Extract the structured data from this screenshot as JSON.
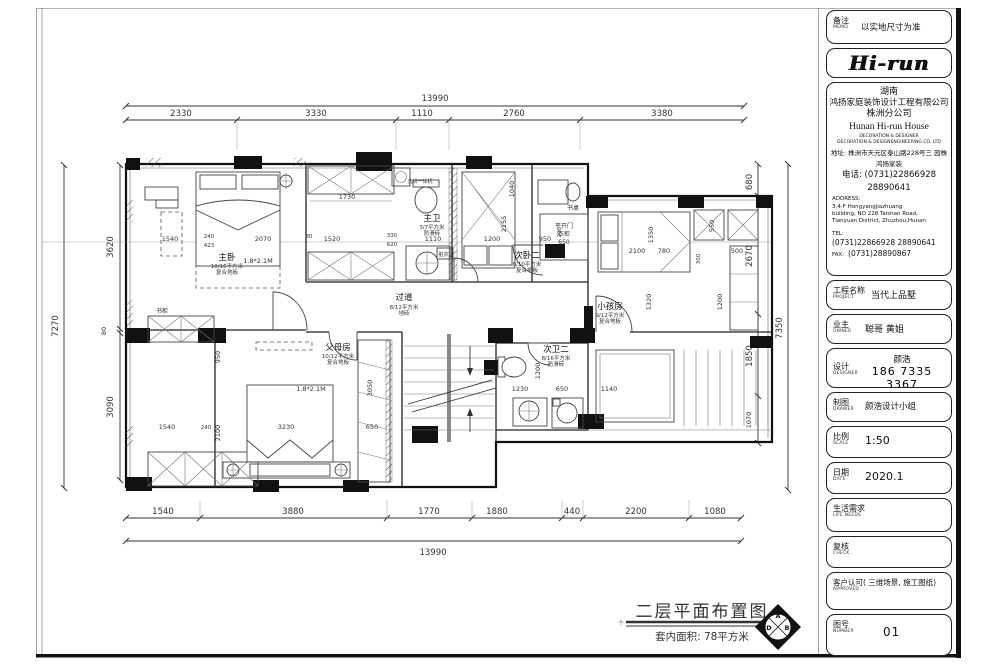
{
  "titleblock": {
    "memo": {
      "label": "备注",
      "en": "MEMO",
      "value": "以实地尺寸为准"
    },
    "logo": "Hi-run",
    "company": {
      "region": "湖南",
      "name": "鸿扬家庭装饰设计工程有限公司",
      "branch": "株洲分公司",
      "name_en": "Hunan  Hi-run  House",
      "tag1": "DECORATION & DESIGNER",
      "tag2": "DECORATION & DESIGNENGINEERING CO. LTD",
      "addr": "地址: 株洲市天元区泰山路228号三 园株",
      "addr2": "鸿扬家装",
      "phone": "电话: (0731)22866928",
      "phone2": "28890641",
      "address_label": "ADDRESS:",
      "address1": "3,4-F Hongyangjiazhuang",
      "address2": "building, NO 228 Taishan Road,",
      "address3": "Tianyuan District, Zhuzhou,Hunan",
      "tel_label": "TEL:",
      "tel": "(0731)22866928",
      "tel2": "28890641",
      "fax_label": "FAX:",
      "fax": "(0731)28890867"
    },
    "project": {
      "label": "工程名称",
      "en": "PROJECT",
      "value": "当代上品墅"
    },
    "owner": {
      "label": "业主",
      "en": "OWNER",
      "value": "聪哥  黄姐"
    },
    "designer": {
      "label": "设计",
      "en": "DESIGNER",
      "value": "颜浩",
      "value2": "186 7335 3367"
    },
    "drawer": {
      "label": "制图",
      "en": "DRAWER",
      "value": "颜浩设计小组"
    },
    "scale": {
      "label": "比例",
      "en": "SCALE",
      "value": "1:50"
    },
    "date": {
      "label": "日期",
      "en": "DATE",
      "value": "2020.1"
    },
    "life": {
      "label": "生活需求",
      "en": "LIFE  NEEDS",
      "value": ""
    },
    "check": {
      "label": "复核",
      "en": "CHECK",
      "value": ""
    },
    "approved": {
      "label": "客户认可( 三维场景, 施工图纸)",
      "en": "APPROVED",
      "value": ""
    },
    "number": {
      "label": "图号",
      "en": "NUMBER",
      "value": "01"
    }
  },
  "footer": {
    "title": "二层平面布置图",
    "area": "套内面积: 78平方米",
    "compass": {
      "top": "A",
      "right": "B",
      "bottom": "C",
      "left": "D"
    }
  },
  "plan": {
    "rooms": {
      "master": {
        "name": "主卧",
        "area": "10/16平方米",
        "floor": "复合地板",
        "bed": "1.8*2.1M"
      },
      "master_bath": {
        "name": "主卫",
        "area": "3/7平方米",
        "floor": "防滑砖"
      },
      "hallway": {
        "name": "过道",
        "area": "8/12平方米",
        "floor": "地砖"
      },
      "second": {
        "name": "次卧二",
        "area": "8/10平方米",
        "floor": "复合地板"
      },
      "kids": {
        "name": "小孩房",
        "area": "9/12平方米",
        "floor": "复合地板"
      },
      "parents": {
        "name": "父母房",
        "area": "10/12平方米",
        "floor": "复合地板",
        "bed": "1.8*2.1M"
      },
      "second_bath": {
        "name": "次卫二",
        "area": "8/16平方米",
        "floor": "防滑砖"
      },
      "desk": {
        "name": "书桌"
      },
      "wardrobe": {
        "line1": "平开门",
        "line2": "衣柜",
        "line3": "650"
      },
      "washer": {
        "name": "洗烘一体机"
      },
      "basket": {
        "name": "脏衣篮"
      },
      "bookcase": {
        "name": "书柜"
      }
    },
    "dims": {
      "top": {
        "overall": "13990",
        "segments": [
          "2330",
          "3330",
          "1110",
          "2760",
          "3380"
        ]
      },
      "bottom": {
        "overall": "13990",
        "segments": [
          "1540",
          "3880",
          "1770",
          "1880",
          "440",
          "2200",
          "1080"
        ]
      },
      "left": {
        "overall": "7270",
        "segments": [
          "3620",
          "80",
          "3090"
        ]
      },
      "right": {
        "overall": "7350",
        "segments": [
          "680",
          "2670",
          "1850",
          "1070"
        ]
      },
      "inner": [
        "1540",
        "240",
        "423",
        "2070",
        "80",
        "1520",
        "330",
        "620",
        "1110",
        "1200",
        "950",
        "290",
        "1730",
        "2155",
        "1040",
        "2100",
        "1350",
        "780",
        "500",
        "550",
        "300",
        "1200",
        "1320",
        "950",
        "2100",
        "240",
        "3230",
        "650",
        "3050",
        "1230",
        "650",
        "1140",
        "1200",
        "1540"
      ]
    }
  }
}
